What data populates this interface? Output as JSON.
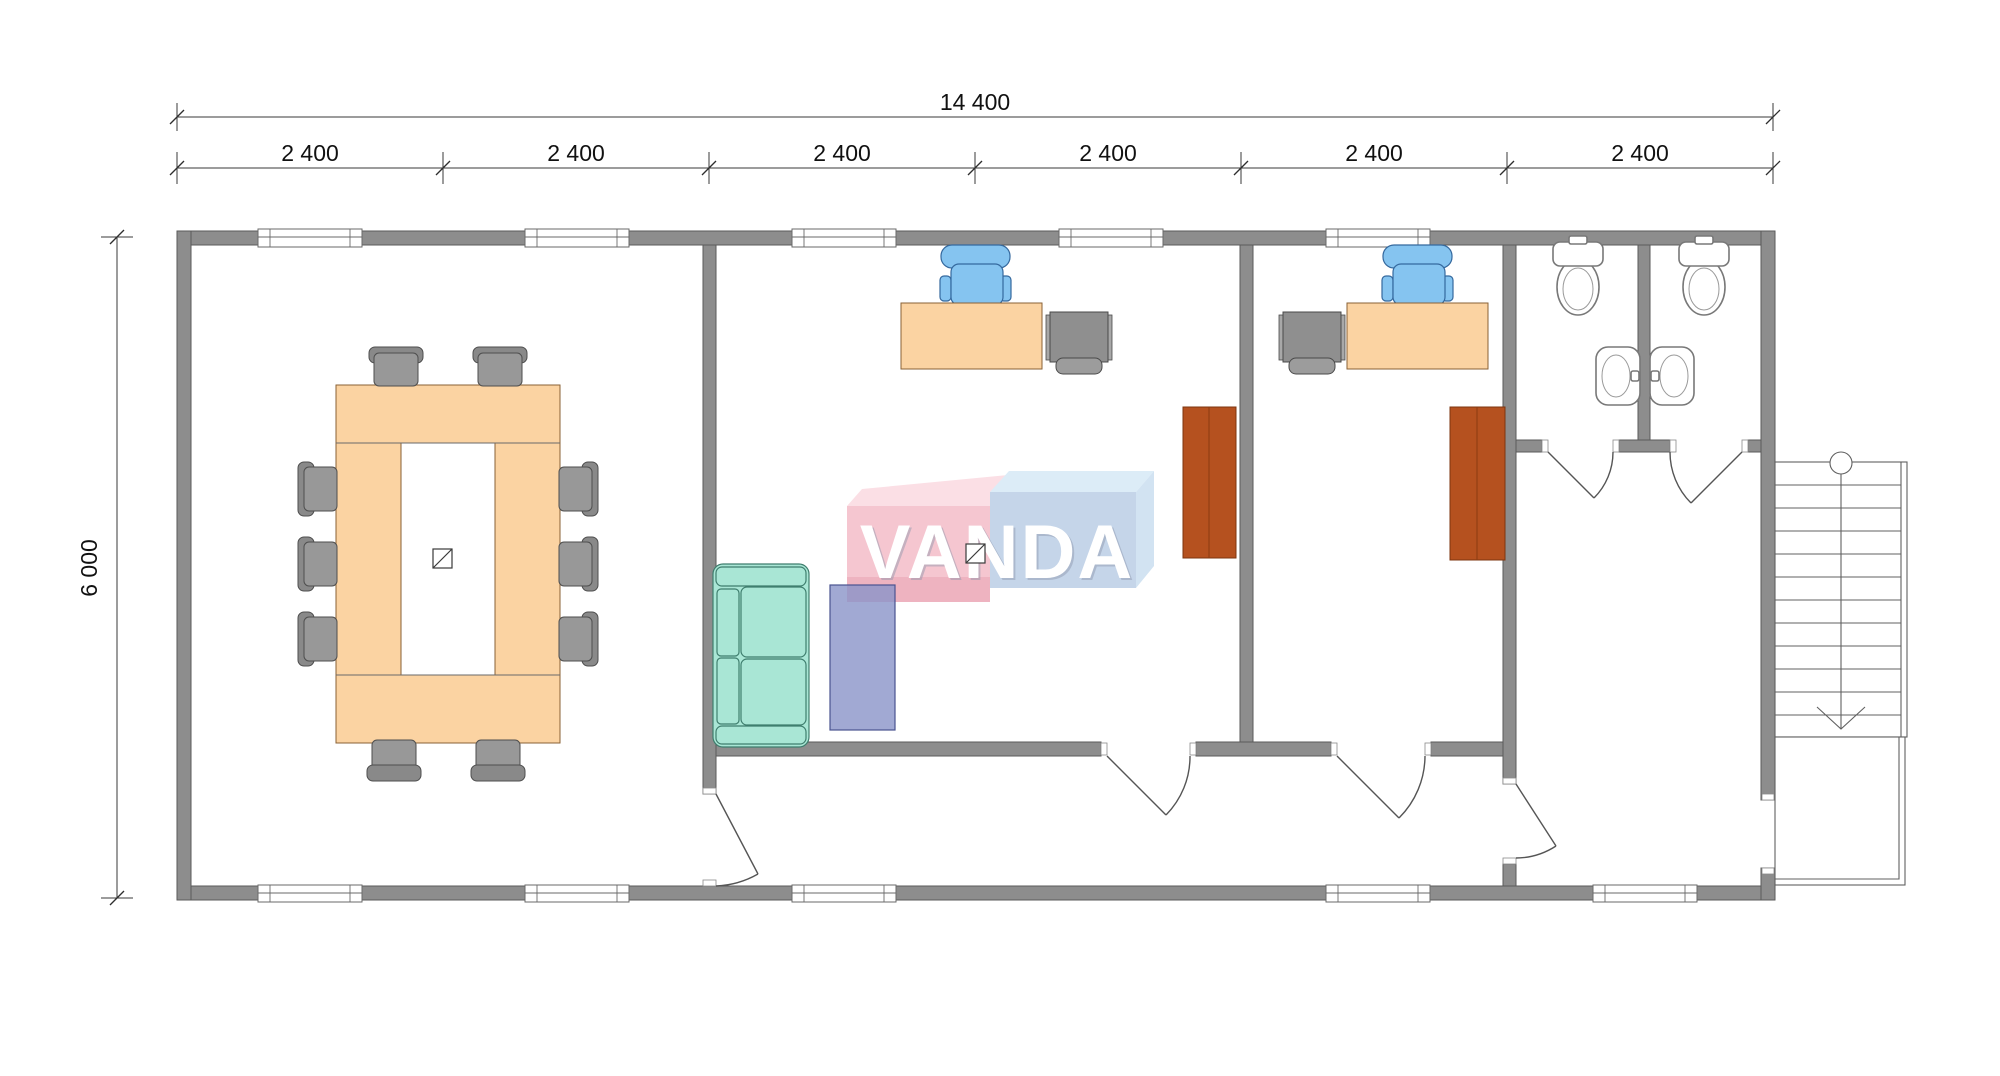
{
  "plan": {
    "watermark_text": "VANDA",
    "dim_total_width": "14 400",
    "dim_height": "6 000",
    "dim_segments": [
      "2 400",
      "2 400",
      "2 400",
      "2 400",
      "2 400",
      "2 400"
    ],
    "colors": {
      "wall_gray": "#8d8d8d",
      "furniture_wood": "#fbd3a2",
      "conference_chair_gray": "#929292",
      "office_chair_blue": "#85c4f0",
      "sofa_mint": "#a9e6d5",
      "wardrobe_rust": "#b5511f",
      "rug_violet": "#8a93c8",
      "logo_pink": "#f5c6d0",
      "logo_blue": "#c5d5e9"
    }
  }
}
